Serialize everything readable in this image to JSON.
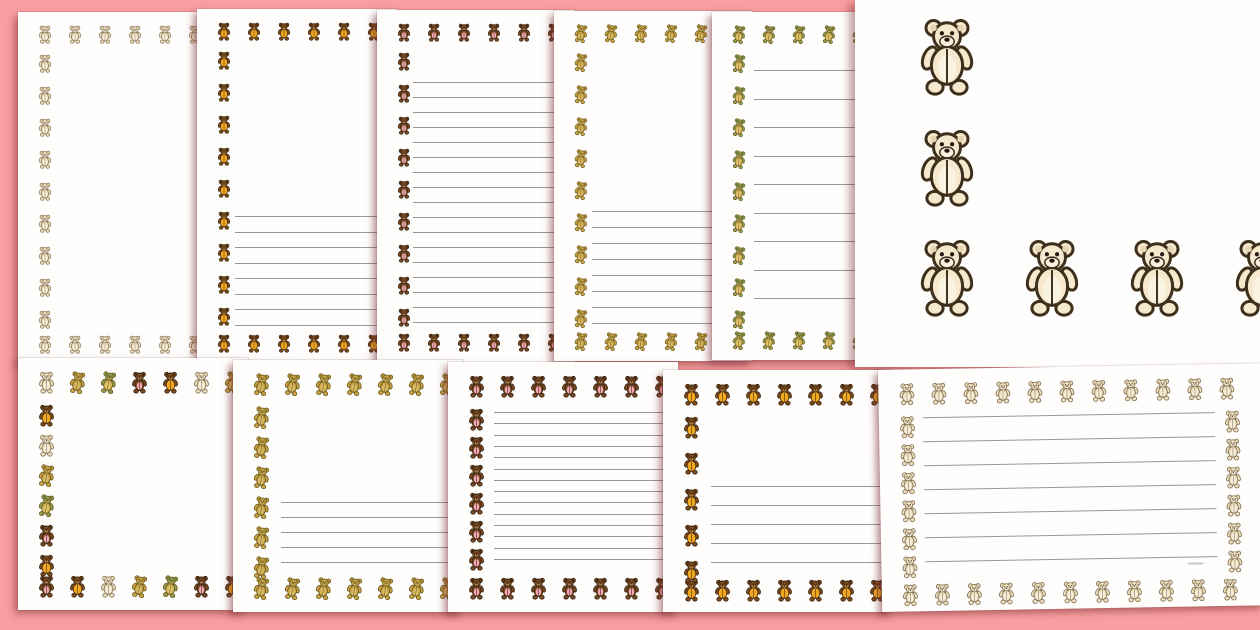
{
  "title": "Teddy bear page borders preview sheet",
  "canvas": {
    "width": 1260,
    "height": 630,
    "background": "#f99fa1",
    "page_color": "#fffefd",
    "line_color": "#979797"
  },
  "bear_styles": {
    "cream": {
      "label": "cream teddy",
      "head": "#eee0c1",
      "body": "#eee0c1",
      "belly": "#f7eedb",
      "ear": "#d8c7a4",
      "muzzle": "#f7eedb",
      "outline": "#847253",
      "face": "#4e3e2a",
      "tilt": 0
    },
    "orange": {
      "label": "brown teddy in orange",
      "head": "#7c4d1e",
      "body": "#f0a820",
      "belly": "#f0a820",
      "ear": "#3c2410",
      "muzzle": "#c08a46",
      "outline": "#3c2410",
      "face": "#2a1808",
      "tilt": 0
    },
    "pink": {
      "label": "brown teddy in pink",
      "head": "#7b4b25",
      "body": "#7b4b25",
      "belly": "#f4a8b8",
      "ear": "#33200e",
      "muzzle": "#bf8e58",
      "outline": "#36220f",
      "face": "#2a1808",
      "tilt": 0
    },
    "gold": {
      "label": "gold walking teddy",
      "head": "#c9a547",
      "body": "#c9a547",
      "belly": "#d9bb66",
      "ear": "#8a7426",
      "muzzle": "#d9bb66",
      "outline": "#6d5b1e",
      "face": "#3c3110",
      "tilt": 9
    },
    "greenhat": {
      "label": "gold teddy, green head",
      "head": "#8f9d51",
      "body": "#d3b258",
      "belly": "#e1c56b",
      "ear": "#6d7a38",
      "muzzle": "#c8b15e",
      "outline": "#6d5b1e",
      "face": "#3c3110",
      "tilt": 9
    },
    "bigcream": {
      "label": "large cream teddy",
      "head": "#f5e8cd",
      "body": "#f5e8cd",
      "belly": "#faf3e2",
      "ear": "#e6d5b2",
      "muzzle": "#f9f1de",
      "outline": "#3e2f1d",
      "face": "#241a10",
      "tilt": 0
    }
  },
  "mixed_border": {
    "sequence": [
      "cream",
      "gold",
      "greenhat",
      "pink",
      "orange"
    ],
    "offsets": {
      "top": 0,
      "left": 4,
      "bottom": 3,
      "right": 1
    }
  },
  "pages": [
    {
      "id": "portrait-cream-blank",
      "variant": "portrait, plain",
      "style": "cream",
      "left": 18,
      "top": 12,
      "width": 200,
      "height": 352,
      "z": 1,
      "bear": {
        "size": 14,
        "inset": 20,
        "dx": 30,
        "dy": 32,
        "sides": [
          "top",
          "left",
          "bottom"
        ],
        "botPad": 10
      },
      "lines": null
    },
    {
      "id": "portrait-orange-halflined",
      "variant": "portrait, half lined",
      "style": "orange",
      "left": 197,
      "top": 9,
      "width": 200,
      "height": 354,
      "z": 2,
      "bear": {
        "size": 14,
        "inset": 20,
        "dx": 30,
        "dy": 32,
        "sides": [
          "top",
          "left",
          "bottom"
        ],
        "botPad": 10
      },
      "lines": {
        "count": 8,
        "top": 207,
        "spacing": 15.5,
        "left": 38,
        "right": 0
      }
    },
    {
      "id": "portrait-pink-fully-lined",
      "variant": "portrait, fully lined",
      "style": "pink",
      "left": 377,
      "top": 10,
      "width": 198,
      "height": 352,
      "z": 3,
      "bear": {
        "size": 14,
        "inset": 20,
        "dx": 30,
        "dy": 32,
        "sides": [
          "top",
          "left",
          "bottom"
        ],
        "botPad": 10
      },
      "lines": {
        "count": 17,
        "top": 72,
        "spacing": 15,
        "left": 36,
        "right": 0
      }
    },
    {
      "id": "portrait-gold-halflined",
      "variant": "portrait, half lined",
      "style": "gold",
      "left": 554,
      "top": 11,
      "width": 198,
      "height": 350,
      "z": 4,
      "bear": {
        "size": 14,
        "inset": 20,
        "dx": 30,
        "dy": 32,
        "sides": [
          "top",
          "left",
          "bottom"
        ],
        "botPad": 10
      },
      "lines": {
        "count": 8,
        "top": 200,
        "spacing": 16,
        "left": 38,
        "right": 0
      }
    },
    {
      "id": "portrait-green-wide-lines",
      "variant": "portrait, wide lines",
      "style": "greenhat",
      "left": 712,
      "top": 12,
      "width": 200,
      "height": 348,
      "z": 5,
      "bear": {
        "size": 14,
        "inset": 20,
        "dx": 30,
        "dy": 32,
        "sides": [
          "top",
          "left",
          "bottom"
        ],
        "botPad": 10
      },
      "lines": {
        "count": 9,
        "top": 58,
        "spacing": 28.5,
        "left": 42,
        "right": 0
      }
    },
    {
      "id": "landscape-mixed-blank",
      "variant": "landscape, plain",
      "style": "mixed",
      "left": 18,
      "top": 358,
      "width": 230,
      "height": 252,
      "z": 7,
      "bear": {
        "size": 17,
        "inset": 20,
        "dx": 31,
        "dy": 30,
        "sides": [
          "top",
          "left",
          "bottom"
        ],
        "botPad": 12
      },
      "lines": null
    },
    {
      "id": "landscape-gold-halflined",
      "variant": "landscape, half lined",
      "style": "gold",
      "left": 233,
      "top": 360,
      "width": 230,
      "height": 252,
      "z": 8,
      "bear": {
        "size": 17,
        "inset": 20,
        "dx": 31,
        "dy": 30,
        "sides": [
          "top",
          "left",
          "bottom"
        ],
        "botPad": 12
      },
      "lines": {
        "count": 5,
        "top": 142,
        "spacing": 15,
        "left": 48,
        "right": 8
      }
    },
    {
      "id": "landscape-pink-fully-lined",
      "variant": "landscape, fully lined",
      "style": "pink",
      "left": 448,
      "top": 362,
      "width": 230,
      "height": 250,
      "z": 9,
      "bear": {
        "size": 17,
        "inset": 20,
        "dx": 31,
        "dy": 28,
        "sides": [
          "top",
          "left",
          "bottom"
        ],
        "botPad": 12
      },
      "lines": {
        "count": 14,
        "top": 50,
        "spacing": 11.3,
        "left": 46,
        "right": 8
      }
    },
    {
      "id": "landscape-orange-halflined",
      "variant": "landscape, half lined",
      "style": "orange",
      "left": 663,
      "top": 370,
      "width": 230,
      "height": 242,
      "z": 10,
      "bear": {
        "size": 17,
        "inset": 20,
        "dx": 31,
        "dy": 36,
        "sides": [
          "top",
          "left",
          "bottom"
        ],
        "botPad": 10
      },
      "lines": {
        "count": 5,
        "top": 116,
        "spacing": 19,
        "left": 48,
        "right": 8
      }
    },
    {
      "id": "landscape-cream-fully-lined",
      "variant": "landscape, fully lined",
      "style": "cream",
      "left": 878,
      "top": 370,
      "width": 382,
      "height": 242,
      "z": 11,
      "rotate": -1,
      "bear": {
        "size": 17,
        "inset": 20,
        "dx": 32,
        "dy": 28,
        "sides": [
          "top",
          "left",
          "bottom",
          "right"
        ],
        "botPad": 5
      },
      "lines": {
        "count": 7,
        "top": 48,
        "spacing": 24,
        "left": 44,
        "right": 46
      },
      "watermark_dash": {
        "x": 306,
        "y": 198,
        "w": 16,
        "h": 2
      }
    }
  ],
  "zoom_preview": {
    "id": "zoomed-page-corner",
    "variant": "close-up of border corner, large cream teddies",
    "style": "bigcream",
    "left": 855,
    "top": 0,
    "width": 405,
    "height": 367,
    "z": 6,
    "bear_w": 60,
    "column": {
      "x": 62,
      "ys": [
        16,
        127
      ]
    },
    "row": {
      "y": 237,
      "xs": [
        62,
        167,
        272,
        377
      ]
    }
  }
}
